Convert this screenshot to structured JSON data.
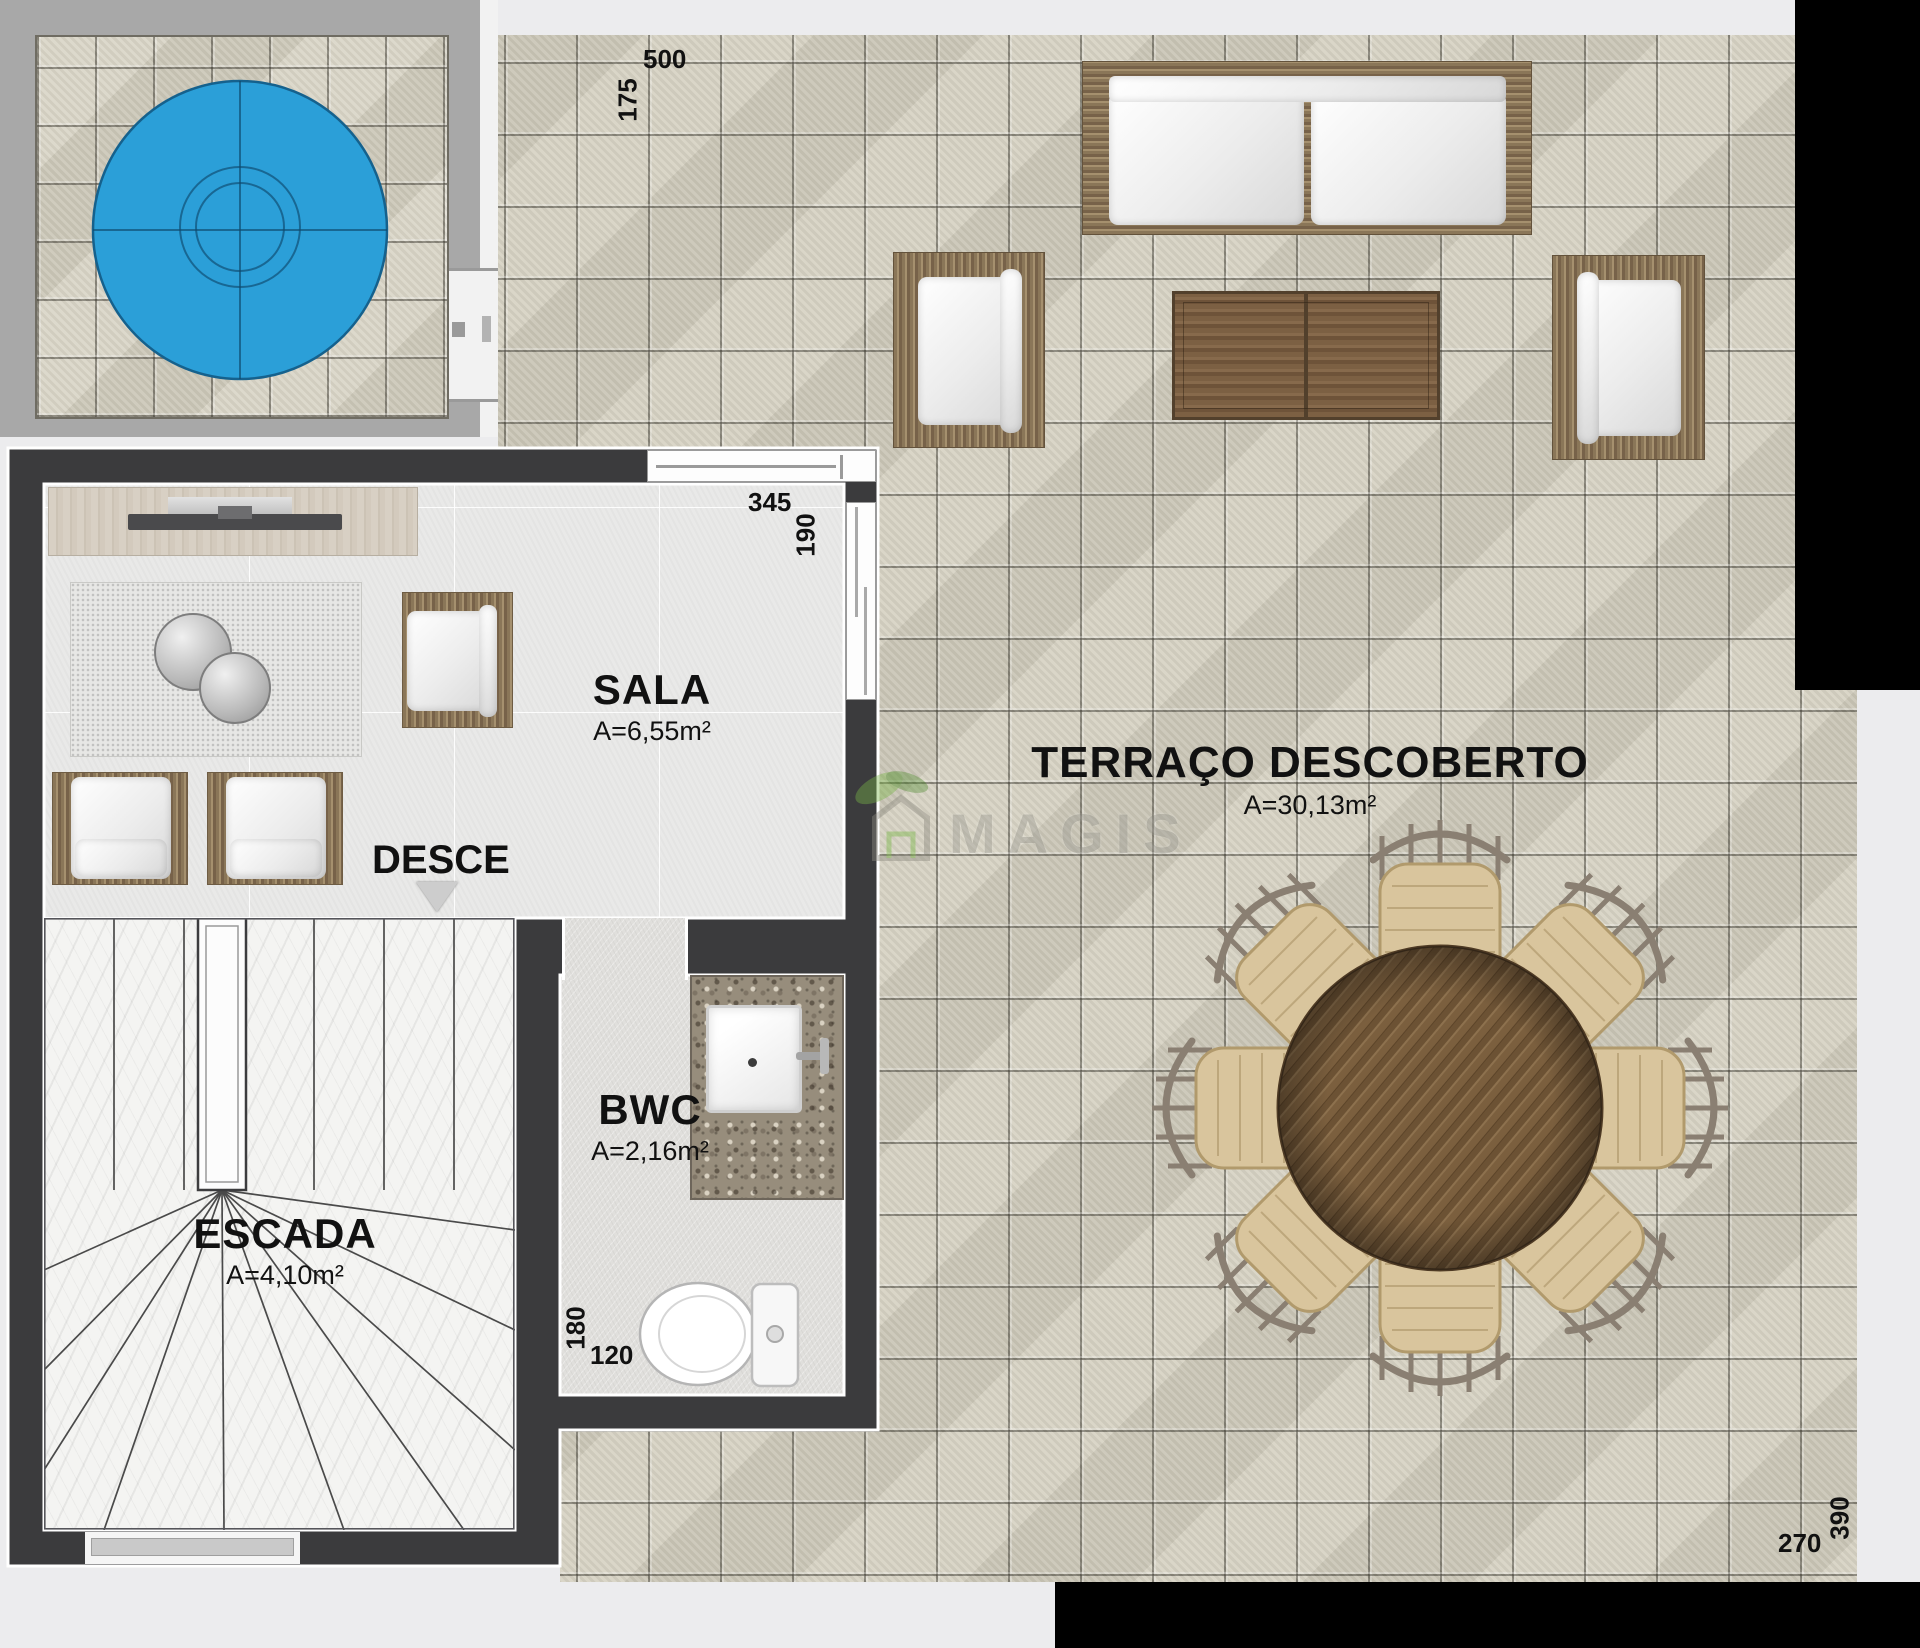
{
  "rooms": {
    "sala": {
      "name": "SALA",
      "area": "A=6,55m²"
    },
    "terraco": {
      "name": "TERRAÇO DESCOBERTO",
      "area": "A=30,13m²"
    },
    "bwc": {
      "name": "BWC",
      "area": "A=2,16m²"
    },
    "escada": {
      "name": "ESCADA",
      "area": "A=4,10m²"
    }
  },
  "labels": {
    "stairs_direction": "DESCE"
  },
  "dimensions": {
    "terrace_top_width": "500",
    "terrace_top_height": "175",
    "sala_width": "345",
    "sala_height": "190",
    "bwc_depth": "180",
    "bwc_width": "120",
    "terrace_bottom_width": "270",
    "terrace_bottom_height": "390"
  },
  "watermark": {
    "brand": "MAGIS"
  },
  "colors": {
    "pool_water": "#2b9fd8",
    "wall": "#3b3b3d",
    "terrace_tile": "#d2cec0",
    "label_text": "#111111"
  }
}
